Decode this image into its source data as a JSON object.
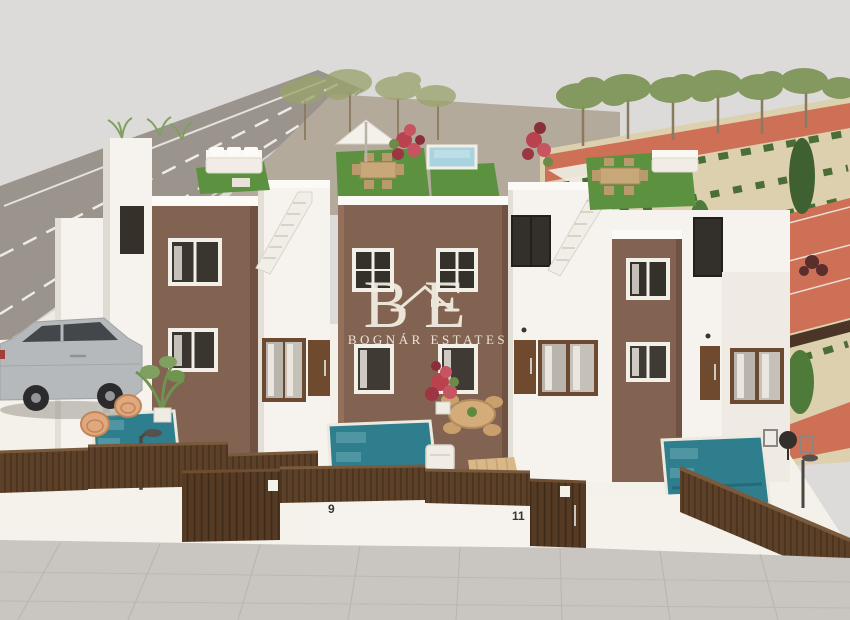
{
  "watermark": {
    "monogram_left": "B",
    "monogram_right": "E",
    "name": "BOGNÁR ESTATES"
  },
  "gates": {
    "left_house_number": "9",
    "right_house_number": "11"
  },
  "colors": {
    "sky": "#dcdbd9",
    "road": "#9a948d",
    "road_marking": "#f2f0ec",
    "gravel": "#b3aa9c",
    "terracotta": "#cd7055",
    "sand": "#ddd0ae",
    "hedge_green": "#4a6e35",
    "tree_green": "#7d9455",
    "building_white": "#f6f3ee",
    "accent_wall_brown": "#826250",
    "turf_green": "#5c9140",
    "pool_water": "#2f7e8e",
    "roof_pool_water": "#a9d3de",
    "fence_brown": "#5d4028",
    "door_brown": "#6f4a2e",
    "sidewalk": "#c9c5c0",
    "watermark_ivory": "#f3eee4"
  }
}
